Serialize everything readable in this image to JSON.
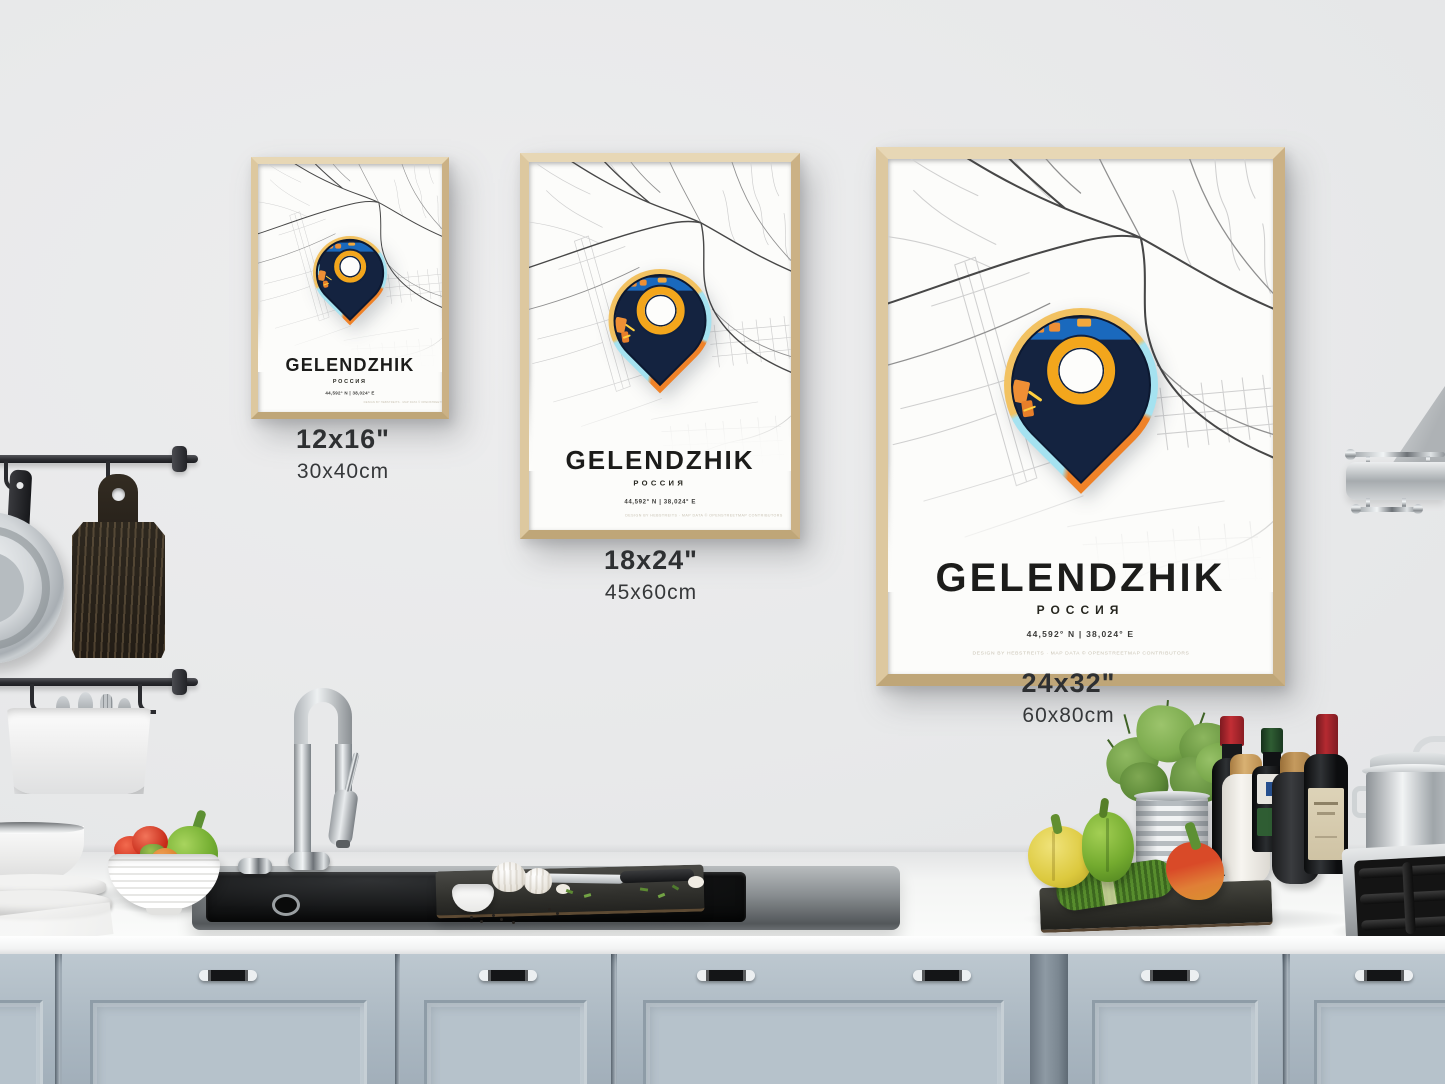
{
  "poster": {
    "title": "GELENDZHIK",
    "subtitle": "РОССИЯ",
    "coordinates": "44,592° N | 38,024° E",
    "credit": "DESIGN BY HEBSTREITS · MAP DATA © OPENSTREETMAP CONTRIBUTORS",
    "sizes": [
      {
        "inches": "12x16\"",
        "cm": "30x40cm"
      },
      {
        "inches": "18x24\"",
        "cm": "45x60cm"
      },
      {
        "inches": "24x32\"",
        "cm": "60x80cm"
      }
    ]
  },
  "colors": {
    "wall": "#e8e9ea",
    "frame_wood": "#d9c49c",
    "pin_navy": "#142340",
    "pin_gold": "#f2c262",
    "pin_orange": "#ef8228",
    "pin_cyan": "#a5e2f0",
    "ring_yellow": "#f3a61c",
    "cabinet_blue_gray": "#b1bdc6",
    "counter_white": "#f6f7f6"
  }
}
